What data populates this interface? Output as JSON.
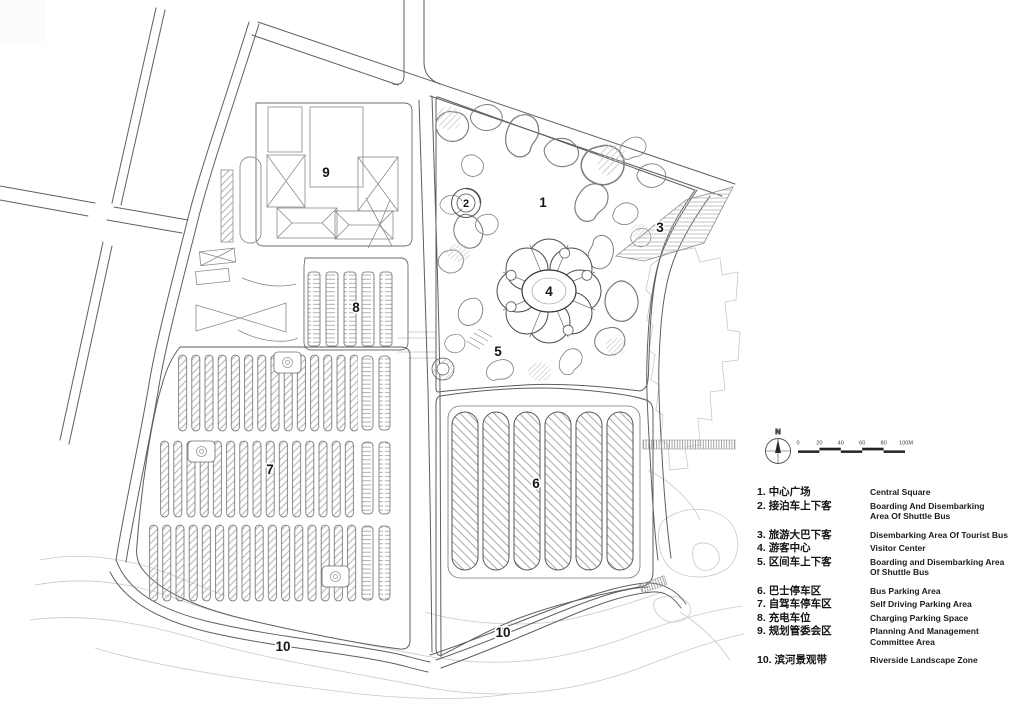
{
  "plan": {
    "area_numbers": {
      "n1": "1",
      "n2": "2",
      "n3": "3",
      "n4": "4",
      "n5": "5",
      "n6": "6",
      "n7": "7",
      "n8": "8",
      "n9": "9",
      "n10": "10"
    }
  },
  "compass": {
    "north_label": "N"
  },
  "scalebar": {
    "labels": [
      "0",
      "20",
      "40",
      "60",
      "80",
      "100M"
    ]
  },
  "legend": {
    "items": [
      {
        "num": "1.",
        "zh": "中心广场",
        "en": "Central Square"
      },
      {
        "num": "2.",
        "zh": "接泊车上下客",
        "en": "Boarding And Disembarking\nArea Of Shuttle Bus"
      },
      {
        "num": "3.",
        "zh": "旅游大巴下客",
        "en": "Disembarking Area Of Tourist Bus"
      },
      {
        "num": "4.",
        "zh": "游客中心",
        "en": "Visitor Center"
      },
      {
        "num": "5.",
        "zh": "区间车上下客",
        "en": "Boarding and Disembarking Area\nOf Shuttle Bus"
      },
      {
        "num": "6.",
        "zh": "巴士停车区",
        "en": "Bus Parking Area"
      },
      {
        "num": "7.",
        "zh": "自驾车停车区",
        "en": "Self Driving Parking Area"
      },
      {
        "num": "8.",
        "zh": "充电车位",
        "en": "Charging Parking Space"
      },
      {
        "num": "9.",
        "zh": "规划管委会区",
        "en": "Planning And Management\nCommittee Area"
      },
      {
        "num": "10.",
        "zh": "滨河景观带",
        "en": "Riverside Landscape Zone"
      }
    ]
  },
  "colors": {
    "ink": "#5f5f5f",
    "dark_outline": "#4a4a4a",
    "light_context": "#c7c7c7",
    "hatch": "#a8a8a8",
    "label_text": "#161616",
    "background": "#ffffff"
  }
}
